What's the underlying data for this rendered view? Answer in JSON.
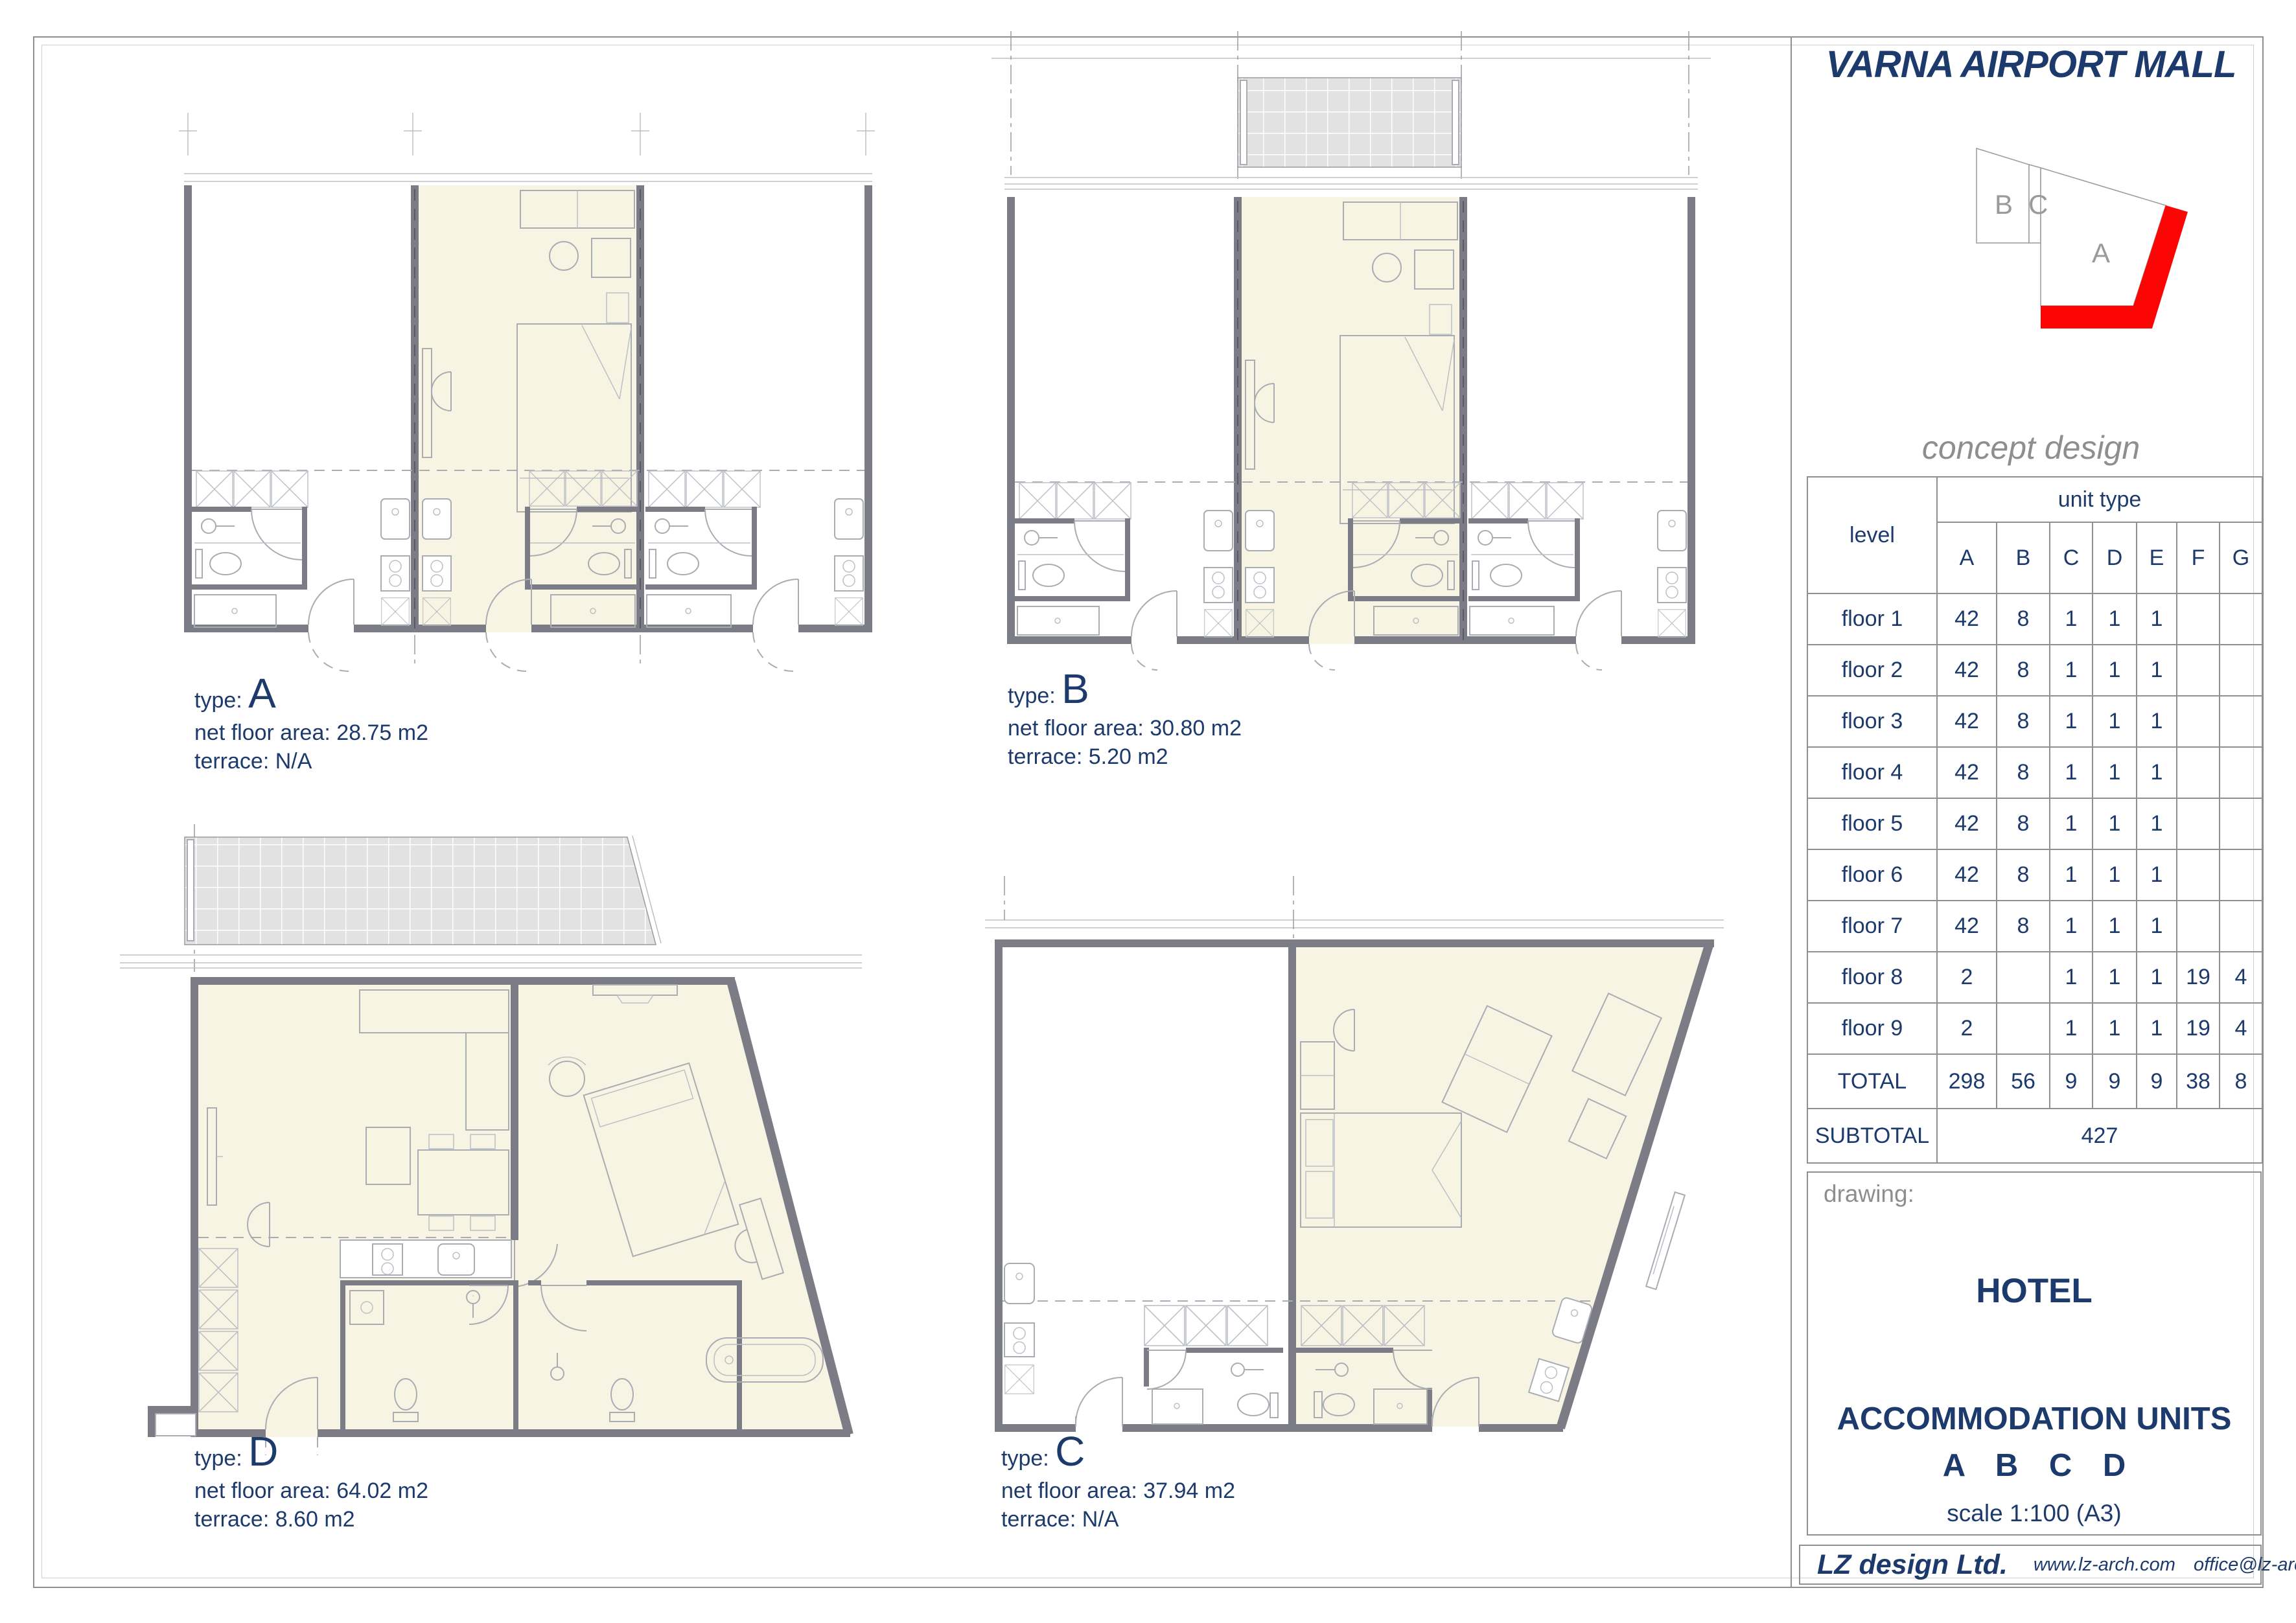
{
  "title": "VARNA AIRPORT MALL",
  "subtitle": "concept design",
  "key_plan": {
    "label_a": "A",
    "label_b": "B",
    "label_c": "C"
  },
  "units": {
    "a": {
      "type_label": "type:",
      "type": "A",
      "area": "net floor area: 28.75 m2",
      "terrace": "terrace: N/A"
    },
    "b": {
      "type_label": "type:",
      "type": "B",
      "area": "net floor area: 30.80 m2",
      "terrace": "terrace: 5.20 m2"
    },
    "c": {
      "type_label": "type:",
      "type": "C",
      "area": "net floor area: 37.94 m2",
      "terrace": "terrace: N/A"
    },
    "d": {
      "type_label": "type:",
      "type": "D",
      "area": "net floor area: 64.02 m2",
      "terrace": "terrace: 8.60 m2"
    }
  },
  "table": {
    "level_header": "level",
    "unit_type_header": "unit type",
    "columns": [
      "A",
      "B",
      "C",
      "D",
      "E",
      "F",
      "G"
    ],
    "rows": [
      {
        "label": "floor 1",
        "values": [
          "42",
          "8",
          "1",
          "1",
          "1",
          "",
          ""
        ]
      },
      {
        "label": "floor 2",
        "values": [
          "42",
          "8",
          "1",
          "1",
          "1",
          "",
          ""
        ]
      },
      {
        "label": "floor 3",
        "values": [
          "42",
          "8",
          "1",
          "1",
          "1",
          "",
          ""
        ]
      },
      {
        "label": "floor 4",
        "values": [
          "42",
          "8",
          "1",
          "1",
          "1",
          "",
          ""
        ]
      },
      {
        "label": "floor 5",
        "values": [
          "42",
          "8",
          "1",
          "1",
          "1",
          "",
          ""
        ]
      },
      {
        "label": "floor 6",
        "values": [
          "42",
          "8",
          "1",
          "1",
          "1",
          "",
          ""
        ]
      },
      {
        "label": "floor 7",
        "values": [
          "42",
          "8",
          "1",
          "1",
          "1",
          "",
          ""
        ]
      },
      {
        "label": "floor 8",
        "values": [
          "2",
          "",
          "1",
          "1",
          "1",
          "19",
          "4"
        ]
      },
      {
        "label": "floor 9",
        "values": [
          "2",
          "",
          "1",
          "1",
          "1",
          "19",
          "4"
        ]
      },
      {
        "label": "TOTAL",
        "values": [
          "298",
          "56",
          "9",
          "9",
          "9",
          "38",
          "8"
        ]
      }
    ],
    "subtotal_label": "SUBTOTAL",
    "subtotal_value": "427"
  },
  "drawing_block": {
    "label": "drawing:",
    "line1": "HOTEL",
    "line2": "ACCOMMODATION UNITS",
    "line3": "A B C D",
    "scale": "scale 1:100 (A3)"
  },
  "footer": {
    "company": "LZ design Ltd.",
    "website": "www.lz-arch.com",
    "email": "office@lz-arch.com"
  },
  "colors": {
    "navy": "#1d3a6d",
    "gray_text": "#8e8e8e",
    "red": "#fb0505",
    "beige": "#f7f4e3",
    "wall": "#7c7c86",
    "line": "#a9adb3",
    "border": "#8f8f8f",
    "terrace_fill": "#e2e2e2"
  },
  "chart_data": {
    "type": "table",
    "title": "unit type per level",
    "categories": [
      "A",
      "B",
      "C",
      "D",
      "E",
      "F",
      "G"
    ],
    "rows": [
      {
        "level": "floor 1",
        "values": [
          42,
          8,
          1,
          1,
          1,
          null,
          null
        ]
      },
      {
        "level": "floor 2",
        "values": [
          42,
          8,
          1,
          1,
          1,
          null,
          null
        ]
      },
      {
        "level": "floor 3",
        "values": [
          42,
          8,
          1,
          1,
          1,
          null,
          null
        ]
      },
      {
        "level": "floor 4",
        "values": [
          42,
          8,
          1,
          1,
          1,
          null,
          null
        ]
      },
      {
        "level": "floor 5",
        "values": [
          42,
          8,
          1,
          1,
          1,
          null,
          null
        ]
      },
      {
        "level": "floor 6",
        "values": [
          42,
          8,
          1,
          1,
          1,
          null,
          null
        ]
      },
      {
        "level": "floor 7",
        "values": [
          42,
          8,
          1,
          1,
          1,
          null,
          null
        ]
      },
      {
        "level": "floor 8",
        "values": [
          2,
          null,
          1,
          1,
          1,
          19,
          4
        ]
      },
      {
        "level": "floor 9",
        "values": [
          2,
          null,
          1,
          1,
          1,
          19,
          4
        ]
      },
      {
        "level": "TOTAL",
        "values": [
          298,
          56,
          9,
          9,
          9,
          38,
          8
        ]
      }
    ],
    "subtotal": 427
  }
}
